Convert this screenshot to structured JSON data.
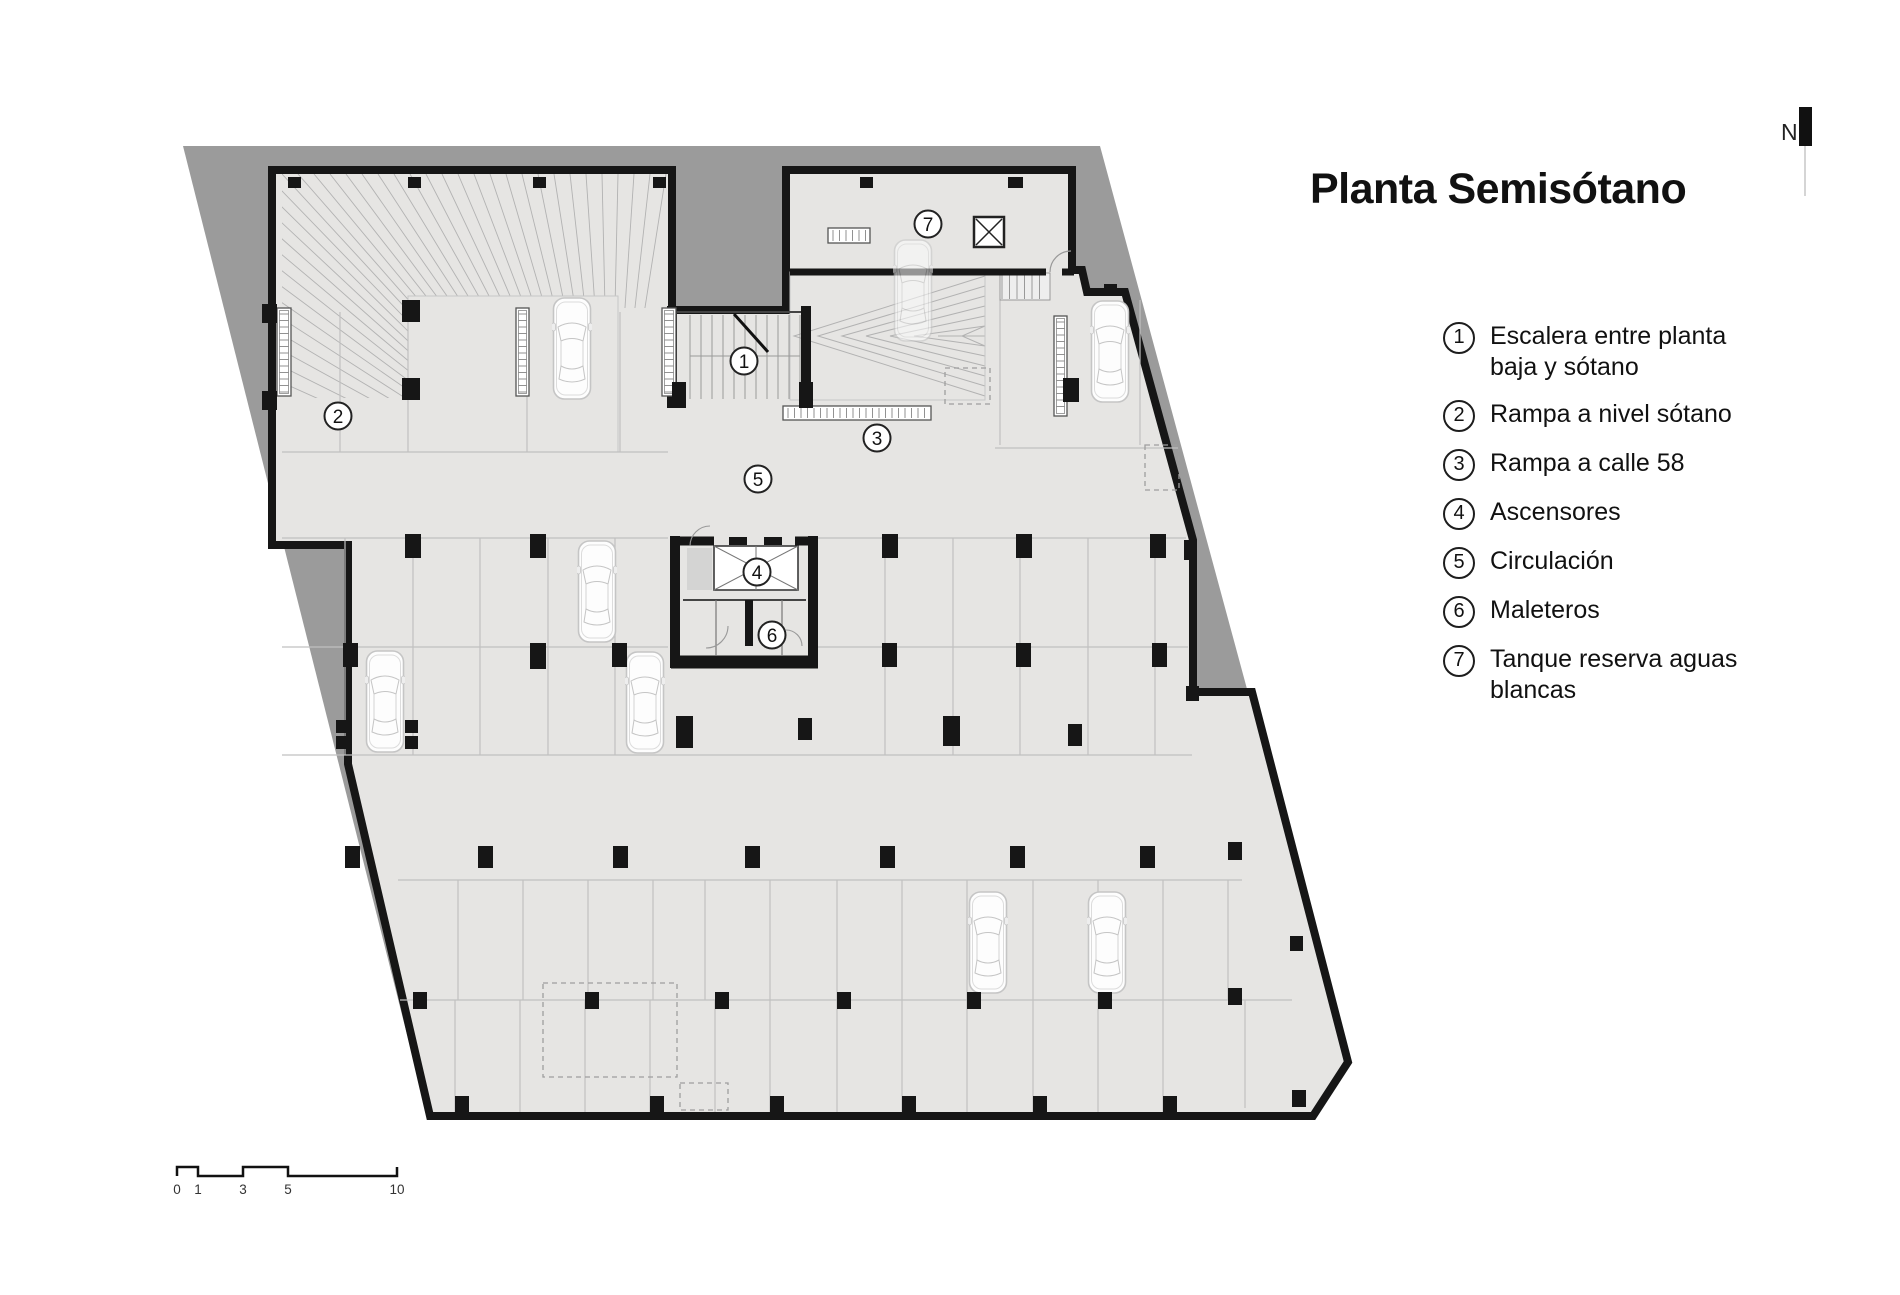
{
  "title": "Planta Semisótano",
  "north": {
    "label": "N"
  },
  "legend": {
    "items": [
      {
        "num": "1",
        "text": "Escalera entre planta baja y sótano"
      },
      {
        "num": "2",
        "text": "Rampa a nivel sótano"
      },
      {
        "num": "3",
        "text": "Rampa a calle 58"
      },
      {
        "num": "4",
        "text": "Ascensores"
      },
      {
        "num": "5",
        "text": "Circulación"
      },
      {
        "num": "6",
        "text": "Maleteros"
      },
      {
        "num": "7",
        "text": "Tanque reserva aguas blancas"
      }
    ]
  },
  "plan": {
    "markers": [
      {
        "num": "1",
        "x": 744,
        "y": 361
      },
      {
        "num": "2",
        "x": 338,
        "y": 416
      },
      {
        "num": "3",
        "x": 877,
        "y": 438
      },
      {
        "num": "4",
        "x": 757,
        "y": 572
      },
      {
        "num": "5",
        "x": 758,
        "y": 479
      },
      {
        "num": "6",
        "x": 772,
        "y": 635
      },
      {
        "num": "7",
        "x": 928,
        "y": 224
      }
    ]
  },
  "scale_bar": {
    "marks": [
      {
        "label": "0",
        "x": 177
      },
      {
        "label": "1",
        "x": 198
      },
      {
        "label": "3",
        "x": 243
      },
      {
        "label": "5",
        "x": 288
      },
      {
        "label": "10",
        "x": 397
      }
    ]
  },
  "colors": {
    "site": "#9b9b9b",
    "floor": "#e6e5e3",
    "wall": "#161616",
    "hatch": "#b2b2b2"
  }
}
